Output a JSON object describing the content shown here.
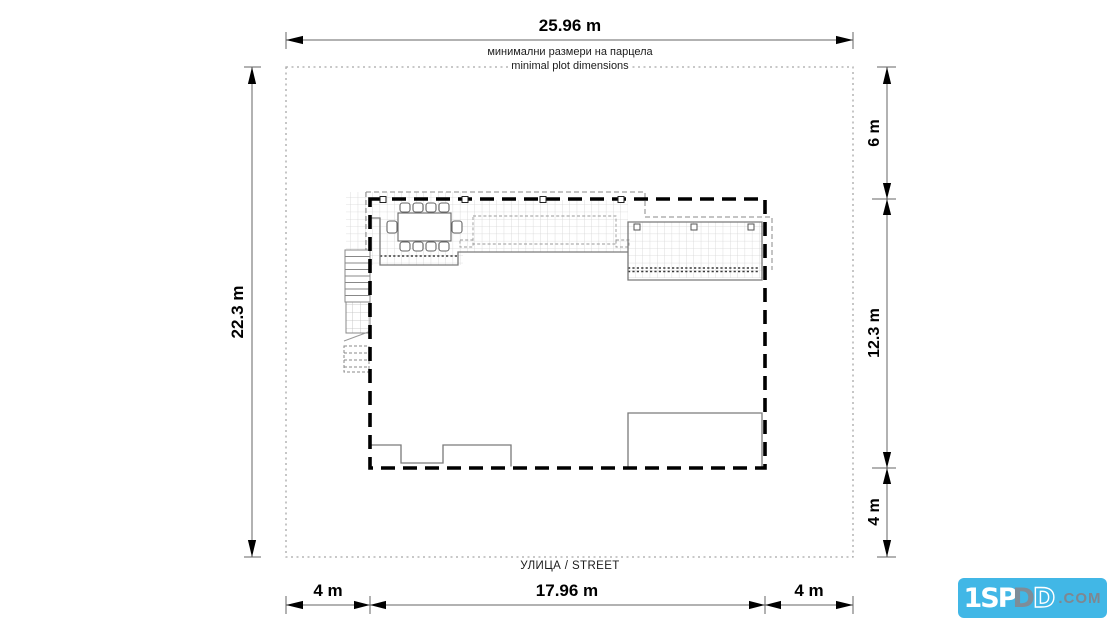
{
  "plan": {
    "note": {
      "line1_bg": "минимални размери на парцела",
      "line2_en": "minimal plot dimensions"
    },
    "street_label": "УЛИЦА / STREET",
    "dimensions": {
      "top_plot_width": "25.96 m",
      "left_plot_depth": "22.3 m",
      "right_setback_top": "6 m",
      "right_building_depth": "12.3 m",
      "right_setback_bottom": "4 m",
      "bottom_setback_left": "4 m",
      "bottom_building_width": "17.96 m",
      "bottom_setback_right": "4 m"
    },
    "colors": {
      "envelope_line": "#000000",
      "plot_boundary_line": "#a8a8a8",
      "wall_line": "#7a7a7a",
      "grid_hatch_line": "#d6d6d6",
      "dimension_line": "#666666"
    }
  },
  "watermark": {
    "part_1": "1SP",
    "part_2": "D",
    "part_3": "D",
    "suffix": ".COM",
    "bg_color": "#41b7e6"
  }
}
